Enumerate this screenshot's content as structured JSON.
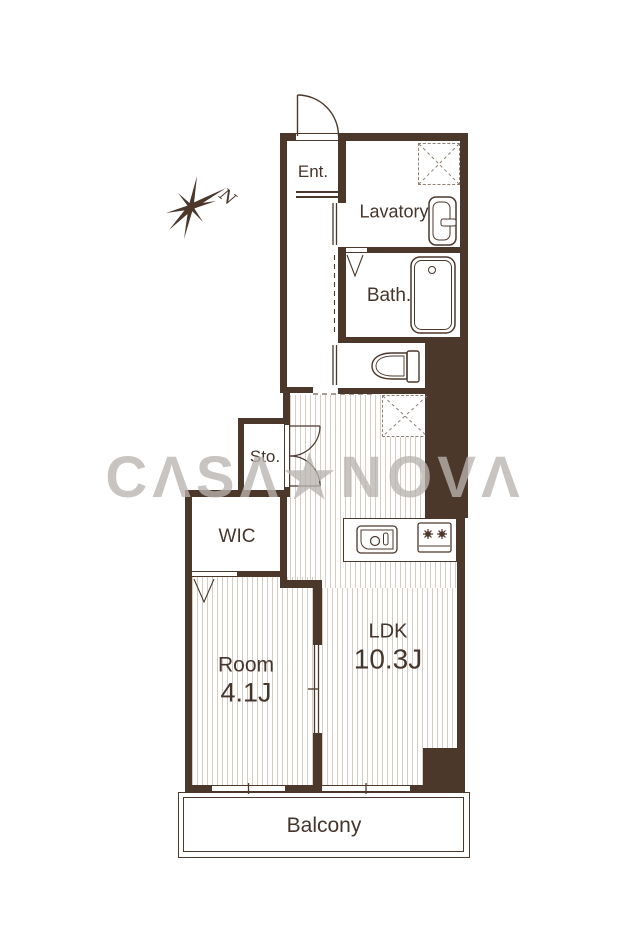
{
  "watermark": {
    "text": "CΛSΛ★NOVΛ"
  },
  "compass": {
    "label": "N"
  },
  "rooms": {
    "ent": {
      "label": "Ent."
    },
    "lavatory": {
      "label": "Lavatory"
    },
    "bath": {
      "label": "Bath."
    },
    "sto": {
      "label": "Sto."
    },
    "wic": {
      "label": "WIC"
    },
    "room": {
      "label": "Room",
      "size": "4.1J"
    },
    "ldk": {
      "label": "LDK",
      "size": "10.3J"
    },
    "balcony": {
      "label": "Balcony"
    }
  },
  "colors": {
    "wall": "#4c372b",
    "line": "#4c372b",
    "hatch": "#d6ccc1",
    "text": "#46352a",
    "bg": "#ffffff",
    "watermark": "#b9b4b0"
  }
}
